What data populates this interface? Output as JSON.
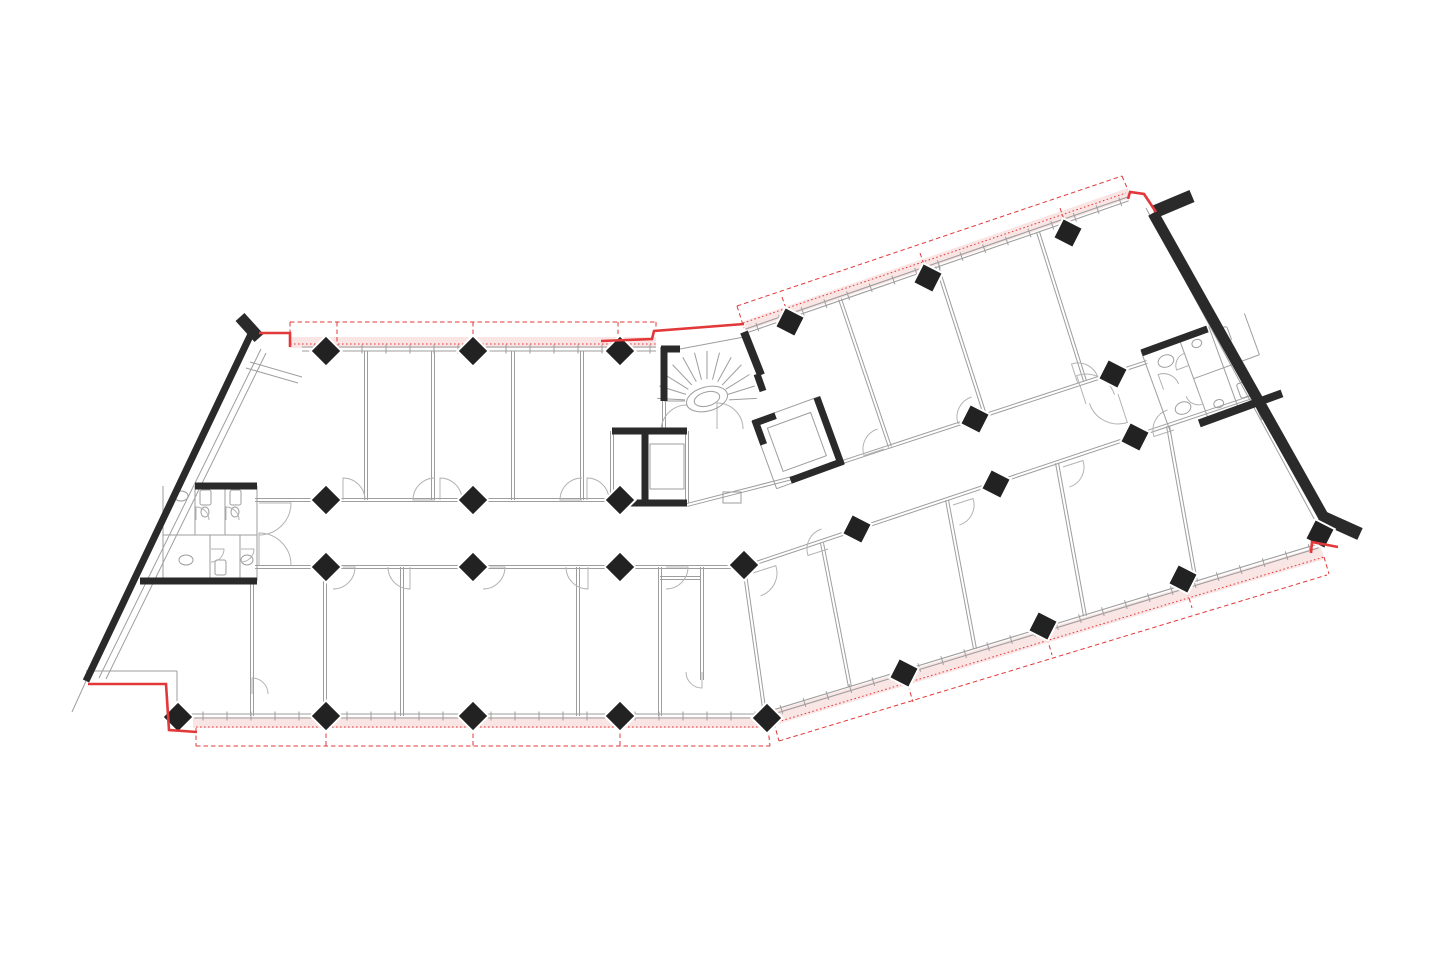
{
  "meta": {
    "aria_label": "Architectural floor plan drawing of a bent office building with red facade renovation markings",
    "drawing_type": "floor-plan"
  },
  "canvas": {
    "w": 1440,
    "h": 960,
    "bg": "#ffffff"
  },
  "colors": {
    "wall": "#2a2a2a",
    "column": "#222222",
    "thin": "#9e9e9e",
    "light": "#c9c9c9",
    "arc": "#b3b3b3",
    "red": "#e2383a",
    "pink": "#f6cfcf",
    "white": "#ffffff"
  },
  "columns": {
    "half": 11,
    "left_rot": 45,
    "right_rot": 27,
    "left": [
      [
        326,
        351
      ],
      [
        473,
        351
      ],
      [
        620,
        351
      ],
      [
        326,
        500
      ],
      [
        473,
        500
      ],
      [
        620,
        500
      ],
      [
        326,
        567
      ],
      [
        473,
        567
      ],
      [
        620,
        567
      ],
      [
        744,
        565
      ],
      [
        178,
        717
      ],
      [
        326,
        716
      ],
      [
        473,
        716
      ],
      [
        620,
        716
      ],
      [
        767,
        718
      ]
    ],
    "right": [
      [
        790,
        322
      ],
      [
        928,
        278
      ],
      [
        1068,
        233
      ],
      [
        975,
        419
      ],
      [
        1113,
        374
      ],
      [
        857,
        529
      ],
      [
        996,
        484
      ],
      [
        1135,
        437
      ],
      [
        904,
        673
      ],
      [
        1043,
        626
      ],
      [
        1183,
        579
      ],
      [
        1320,
        534
      ]
    ]
  },
  "thick_walls": [
    [
      240,
      317,
      259,
      338,
      12
    ],
    [
      251,
      334,
      86,
      681,
      7
    ],
    [
      195,
      486,
      257,
      486,
      7
    ],
    [
      140,
      581,
      257,
      581,
      7
    ],
    [
      1153,
      213,
      1327,
      523,
      11
    ],
    [
      1154,
      212,
      1192,
      196,
      13
    ],
    [
      1320,
      516,
      1360,
      534,
      13
    ],
    [
      661,
      349,
      680,
      349,
      7
    ],
    [
      664,
      347,
      664,
      401,
      7
    ],
    [
      744,
      332,
      761,
      375,
      8
    ],
    [
      757,
      374,
      763,
      391,
      7
    ],
    [
      612,
      431,
      687,
      431,
      7
    ],
    [
      612,
      503,
      687,
      503,
      7
    ],
    [
      645,
      431,
      645,
      503,
      7
    ]
  ],
  "thin_doubles": [
    [
      255,
      500,
      612,
      500
    ],
    [
      255,
      567,
      744,
      567
    ],
    [
      687,
      505,
      800,
      476
    ],
    [
      800,
      476,
      1147,
      362
    ],
    [
      744,
      567,
      1252,
      397
    ],
    [
      366,
      351,
      366,
      500
    ],
    [
      433,
      351,
      433,
      500
    ],
    [
      513,
      351,
      513,
      500
    ],
    [
      582,
      351,
      582,
      500
    ],
    [
      252,
      581,
      252,
      716
    ],
    [
      325,
      567,
      325,
      716
    ],
    [
      402,
      567,
      402,
      716
    ],
    [
      578,
      567,
      578,
      716
    ],
    [
      660,
      567,
      660,
      716
    ],
    [
      702,
      567,
      702,
      680
    ],
    [
      660,
      578,
      700,
      578
    ],
    [
      840,
      299,
      890,
      447
    ],
    [
      937,
      266,
      985,
      415
    ],
    [
      1038,
      232,
      1085,
      381
    ],
    [
      744,
      567,
      765,
      715
    ],
    [
      822,
      543,
      850,
      687
    ],
    [
      947,
      500,
      975,
      649
    ],
    [
      1057,
      463,
      1085,
      616
    ],
    [
      1168,
      426,
      1196,
      582
    ],
    [
      612,
      431,
      612,
      503
    ],
    [
      687,
      431,
      687,
      503
    ],
    [
      664,
      401,
      664,
      431
    ]
  ],
  "thin_singles": [
    [
      99,
      678,
      261,
      349
    ],
    [
      106,
      679,
      266,
      353
    ],
    [
      86,
      681,
      72,
      712
    ],
    [
      86,
      671,
      177,
      671
    ],
    [
      177,
      671,
      177,
      712
    ],
    [
      246,
      368,
      298,
      383
    ],
    [
      250,
      362,
      302,
      377
    ],
    [
      1146,
      208,
      1318,
      526
    ],
    [
      664,
      352,
      744,
      337
    ],
    [
      664,
      401,
      685,
      401
    ],
    [
      1252,
      397,
      1262,
      420
    ]
  ],
  "thin_rects": [
    [
      650,
      444,
      34,
      45
    ],
    [
      723,
      492,
      18,
      11
    ]
  ],
  "facades": [
    {
      "x1": 302,
      "y1": 349,
      "x2": 656,
      "y2": 349,
      "spacing": 24,
      "tick": 9
    },
    {
      "x1": 746,
      "y1": 331,
      "x2": 1128,
      "y2": 199,
      "spacing": 24,
      "tick": 9
    },
    {
      "x1": 191,
      "y1": 716,
      "x2": 766,
      "y2": 716,
      "spacing": 24,
      "tick": 9
    },
    {
      "x1": 770,
      "y1": 713,
      "x2": 1318,
      "y2": 546,
      "spacing": 24,
      "tick": 9
    }
  ],
  "pink_bands": [
    [
      [
        290,
        337
      ],
      [
        656,
        337
      ],
      [
        656,
        348
      ],
      [
        290,
        348
      ]
    ],
    [
      [
        744,
        321
      ],
      [
        1128,
        188
      ],
      [
        1128,
        199
      ],
      [
        746,
        331
      ]
    ],
    [
      [
        193,
        717
      ],
      [
        767,
        717
      ],
      [
        767,
        728
      ],
      [
        193,
        728
      ]
    ],
    [
      [
        770,
        712
      ],
      [
        1320,
        546
      ],
      [
        1325,
        559
      ],
      [
        775,
        725
      ]
    ]
  ],
  "red_dashed": [
    [
      290,
      322,
      656,
      322
    ],
    [
      290,
      322,
      290,
      334
    ],
    [
      656,
      322,
      656,
      332
    ],
    [
      337,
      322,
      337,
      346
    ],
    [
      473,
      322,
      473,
      346
    ],
    [
      618,
      322,
      618,
      346
    ],
    [
      737,
      306,
      1122,
      176
    ],
    [
      1122,
      176,
      1128,
      190
    ],
    [
      737,
      306,
      744,
      328
    ],
    [
      782,
      297,
      790,
      320
    ],
    [
      920,
      253,
      928,
      276
    ],
    [
      1060,
      208,
      1068,
      231
    ],
    [
      196,
      746,
      770,
      746
    ],
    [
      196,
      728,
      196,
      746
    ],
    [
      326,
      726,
      326,
      746
    ],
    [
      473,
      726,
      473,
      746
    ],
    [
      620,
      726,
      620,
      746
    ],
    [
      768,
      728,
      770,
      746
    ],
    [
      779,
      741,
      1327,
      575
    ],
    [
      774,
      723,
      779,
      741
    ],
    [
      908,
      685,
      913,
      702
    ],
    [
      1047,
      638,
      1052,
      655
    ],
    [
      1187,
      591,
      1192,
      608
    ],
    [
      1324,
      557,
      1329,
      574
    ]
  ],
  "red_dotted": [
    [
      290,
      344,
      656,
      344
    ],
    [
      743,
      323,
      1126,
      193
    ],
    [
      196,
      727,
      768,
      727
    ],
    [
      774,
      723,
      1324,
      557
    ]
  ],
  "red_solid": [
    [
      [
        259,
        333
      ],
      [
        290,
        333
      ],
      [
        290,
        347
      ]
    ],
    [
      [
        601,
        341
      ],
      [
        652,
        339
      ],
      [
        654,
        331
      ],
      [
        744,
        324
      ]
    ],
    [
      [
        1128,
        199
      ],
      [
        1130,
        192
      ],
      [
        1144,
        194
      ],
      [
        1156,
        212
      ]
    ],
    [
      [
        88,
        684
      ],
      [
        166,
        684
      ],
      [
        169,
        730
      ],
      [
        197,
        732
      ]
    ],
    [
      [
        1311,
        553
      ],
      [
        1312,
        542
      ],
      [
        1338,
        547
      ]
    ]
  ],
  "door_arcs": [
    [
      259,
      503,
      32,
      0,
      90
    ],
    [
      259,
      565,
      32,
      270,
      360
    ],
    [
      687,
      431,
      26,
      180,
      270
    ],
    [
      717,
      429,
      26,
      270,
      360
    ],
    [
      343,
      500,
      22,
      270,
      360
    ],
    [
      435,
      500,
      22,
      180,
      270
    ],
    [
      440,
      500,
      22,
      270,
      360
    ],
    [
      582,
      500,
      22,
      180,
      270
    ],
    [
      587,
      500,
      22,
      270,
      360
    ],
    [
      333,
      567,
      22,
      0,
      90
    ],
    [
      410,
      567,
      22,
      90,
      180
    ],
    [
      483,
      567,
      22,
      0,
      90
    ],
    [
      588,
      567,
      22,
      90,
      180
    ],
    [
      666,
      567,
      22,
      0,
      90
    ],
    [
      252,
      694,
      16,
      270,
      360
    ],
    [
      702,
      672,
      16,
      90,
      180
    ],
    [
      884,
      449,
      21,
      162,
      252
    ],
    [
      978,
      417,
      21,
      162,
      252
    ],
    [
      1078,
      384,
      21,
      252,
      342
    ],
    [
      753,
      573,
      24,
      -18,
      72
    ],
    [
      828,
      549,
      21,
      162,
      252
    ],
    [
      953,
      505,
      21,
      -18,
      72
    ],
    [
      1063,
      467,
      21,
      -18,
      72
    ],
    [
      1174,
      430,
      21,
      162,
      252
    ],
    [
      1086,
      404,
      30,
      252,
      342
    ],
    [
      1118,
      394,
      30,
      72,
      162
    ]
  ],
  "stair": {
    "cx": 707,
    "cy": 401,
    "rin": 22,
    "rout": 50,
    "a1": 183,
    "a2": 357,
    "steps": 13,
    "well": {
      "rx": 21,
      "ry": 12,
      "rot": -15
    },
    "well2": {
      "rx": 13,
      "ry": 7,
      "rot": -15
    }
  },
  "rot_elevator": {
    "x": 752,
    "y": 421,
    "angle": -20,
    "size": 72,
    "thick": [
      [
        0,
        3,
        24,
        3,
        7
      ],
      [
        69,
        0,
        69,
        72,
        7
      ],
      [
        16,
        69,
        72,
        69,
        7
      ],
      [
        3,
        0,
        3,
        26,
        7
      ]
    ],
    "outline": [
      [
        0,
        0,
        72,
        0
      ],
      [
        0,
        0,
        0,
        72
      ],
      [
        0,
        72,
        72,
        72
      ],
      [
        72,
        0,
        72,
        72
      ]
    ],
    "car": [
      12,
      12,
      46,
      46
    ]
  },
  "wc_left": {
    "lines": [
      [
        163,
        486,
        163,
        581
      ],
      [
        195,
        486,
        195,
        535
      ],
      [
        225,
        486,
        225,
        535
      ],
      [
        163,
        535,
        257,
        535
      ],
      [
        257,
        486,
        257,
        581
      ],
      [
        210,
        535,
        210,
        581
      ],
      [
        240,
        535,
        240,
        581
      ]
    ],
    "rects": [
      [
        200,
        490,
        11,
        15
      ],
      [
        230,
        490,
        11,
        15
      ],
      [
        215,
        560,
        11,
        15
      ]
    ],
    "ellipses": [
      [
        205,
        512,
        4,
        5
      ],
      [
        235,
        512,
        4,
        5
      ],
      [
        181,
        496,
        7,
        5
      ],
      [
        186,
        560,
        7,
        5
      ],
      [
        247,
        560,
        6,
        5
      ]
    ],
    "arcs": [
      [
        196,
        520,
        13,
        270,
        360
      ],
      [
        226,
        520,
        13,
        270,
        360
      ],
      [
        211,
        549,
        13,
        0,
        90
      ],
      [
        241,
        549,
        13,
        0,
        90
      ]
    ]
  },
  "wc_right": {
    "x": 1141,
    "y": 351,
    "angle": -20,
    "w": 110,
    "h": 88,
    "thick": [
      [
        0,
        2,
        70,
        2,
        7
      ],
      [
        30,
        88,
        118,
        88,
        8
      ]
    ],
    "lines": [
      [
        0,
        0,
        0,
        88
      ],
      [
        40,
        0,
        40,
        88
      ],
      [
        40,
        44,
        110,
        44
      ],
      [
        72,
        0,
        72,
        44
      ],
      [
        72,
        44,
        72,
        88
      ],
      [
        110,
        0,
        110,
        44
      ]
    ],
    "rects": [
      [
        78,
        6,
        11,
        15
      ],
      [
        78,
        64,
        11,
        15
      ]
    ],
    "ellipses": [
      [
        20,
        18,
        8,
        6
      ],
      [
        20,
        68,
        8,
        6
      ],
      [
        55,
        12,
        5,
        4
      ],
      [
        55,
        76,
        5,
        4
      ]
    ],
    "arcs": [
      [
        40,
        30,
        13,
        180,
        270
      ],
      [
        40,
        58,
        13,
        90,
        180
      ],
      [
        8,
        44,
        16,
        270,
        360
      ]
    ]
  }
}
